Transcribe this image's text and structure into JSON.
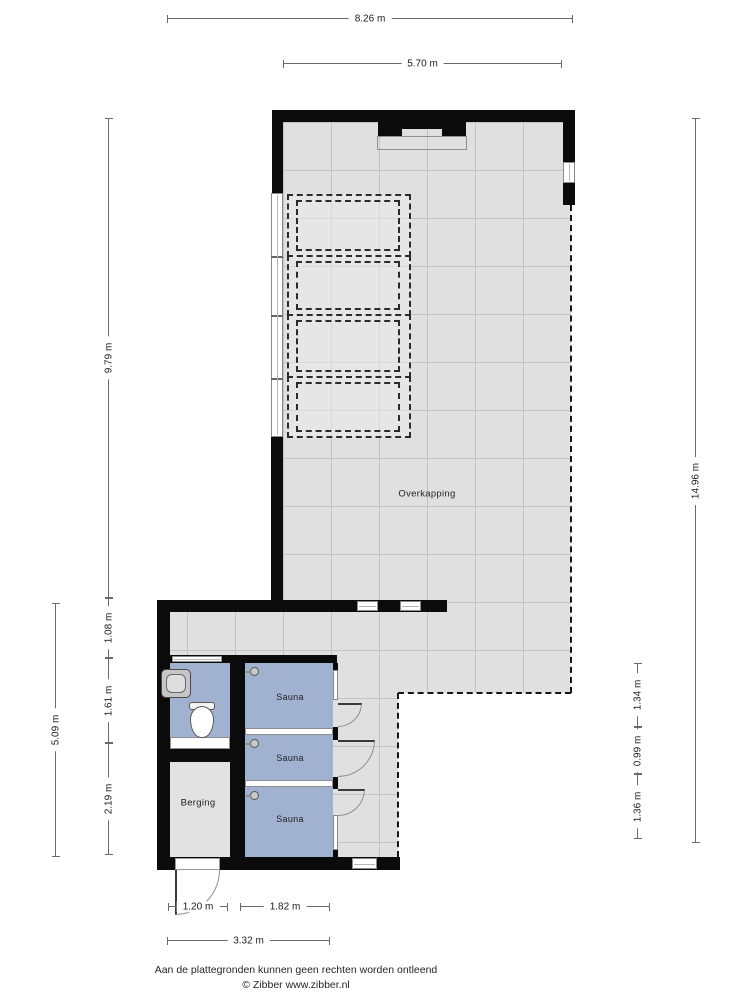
{
  "plan": {
    "rooms": {
      "overkapping": "Overkapping",
      "saunas": [
        "Sauna",
        "Sauna",
        "Sauna"
      ],
      "berging": "Berging"
    },
    "fixtures": {
      "toilet": "toilet-icon",
      "sink": "sink-icon",
      "sauna_lights": [
        "sauna-light-icon",
        "sauna-light-icon",
        "sauna-light-icon"
      ]
    },
    "colors": {
      "wall": "#0b0b0b",
      "floor": "#e0e0e0",
      "grid_line": "#c3c3c3",
      "room_blue": "#a1b2d0",
      "window": "#ffffff"
    }
  },
  "dimensions": {
    "top": [
      "8.26 m",
      "5.70 m"
    ],
    "left": [
      "9.79 m",
      "1.08 m",
      "1.61 m",
      "2.19 m",
      "5.09 m"
    ],
    "right": [
      "14.96 m",
      "1.34 m",
      "0.99 m",
      "1.36 m"
    ],
    "bottom": [
      "1.20 m",
      "1.82 m",
      "3.32 m"
    ]
  },
  "footer": {
    "disclaimer": "Aan de plattegronden kunnen geen rechten worden ontleend",
    "copyright": "© Zibber www.zibber.nl"
  }
}
